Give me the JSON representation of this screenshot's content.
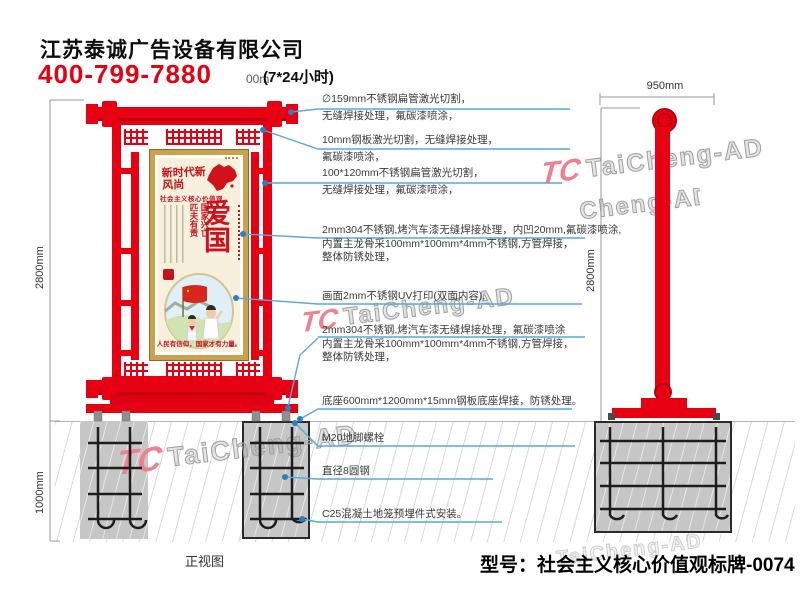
{
  "colors": {
    "accent_red": "#e60012",
    "annotation_blue": "#58a9dc",
    "concrete_gray": "#c6c6c6",
    "watermark_pink": "#ee8090",
    "poster_gold": "#c9a24b"
  },
  "header": {
    "company": "江苏泰诚广告设备有限公司",
    "hotline": "400-799-7880",
    "hotline_suffix": "(7*24小时)",
    "overlap_fragment": "00m"
  },
  "watermark": {
    "logo": "TC",
    "text": "TaiCheng-AD"
  },
  "front_view": {
    "label": "正视图",
    "height_dim": "2800mm",
    "foundation_dim": "1000mm",
    "poster": {
      "calligraphy": "新时代新风尚",
      "banner": "社会主义核心价值观",
      "slogan_col_right": "国家兴亡",
      "slogan_col_left": "匹夫有责",
      "title": "爱国",
      "bottom_slogan": "人民有信仰，国家才有力量。"
    }
  },
  "side_view": {
    "width_dim": "950mm",
    "height_dim": "2800mm"
  },
  "callouts": [
    {
      "lines": [
        "∅159mm不锈钢扁管激光切割，",
        "无缝焊接处理，氟碳漆喷涂，"
      ]
    },
    {
      "lines": [
        "10mm钢板激光切割，无缝焊接处理，",
        "氟碳漆喷涂，"
      ]
    },
    {
      "lines": [
        "100*120mm不锈钢扁管激光切割，",
        "无缝焊接处理，氟碳漆喷涂，"
      ]
    },
    {
      "lines": [
        "2mm304不锈钢,烤汽车漆无缝焊接处理，内凹20mm,氟碳漆喷涂,",
        "内置主龙骨采100mm*100mm*4mm不锈钢,方管焊接，",
        "整体防锈处理，"
      ]
    },
    {
      "lines": [
        "画面2mm不锈钢UV打印(双面内容),"
      ]
    },
    {
      "lines": [
        "2mm304不锈钢,烤汽车漆无缝焊接处理，氟碳漆喷涂",
        "内置主龙骨采100mm*100mm*4mm不锈钢,方管焊接，",
        "整体防锈处理，"
      ]
    },
    {
      "lines": [
        "底座600mm*1200mm*15mm钢板底座焊接，防锈处理。"
      ]
    },
    {
      "lines": [
        "M20地脚螺栓"
      ]
    },
    {
      "lines": [
        "直径8圆钢"
      ]
    },
    {
      "lines": [
        "C25混凝土地笼预埋件式安装。"
      ]
    }
  ],
  "footer": {
    "model": "型号：社会主义核心价值观标牌-0074"
  }
}
